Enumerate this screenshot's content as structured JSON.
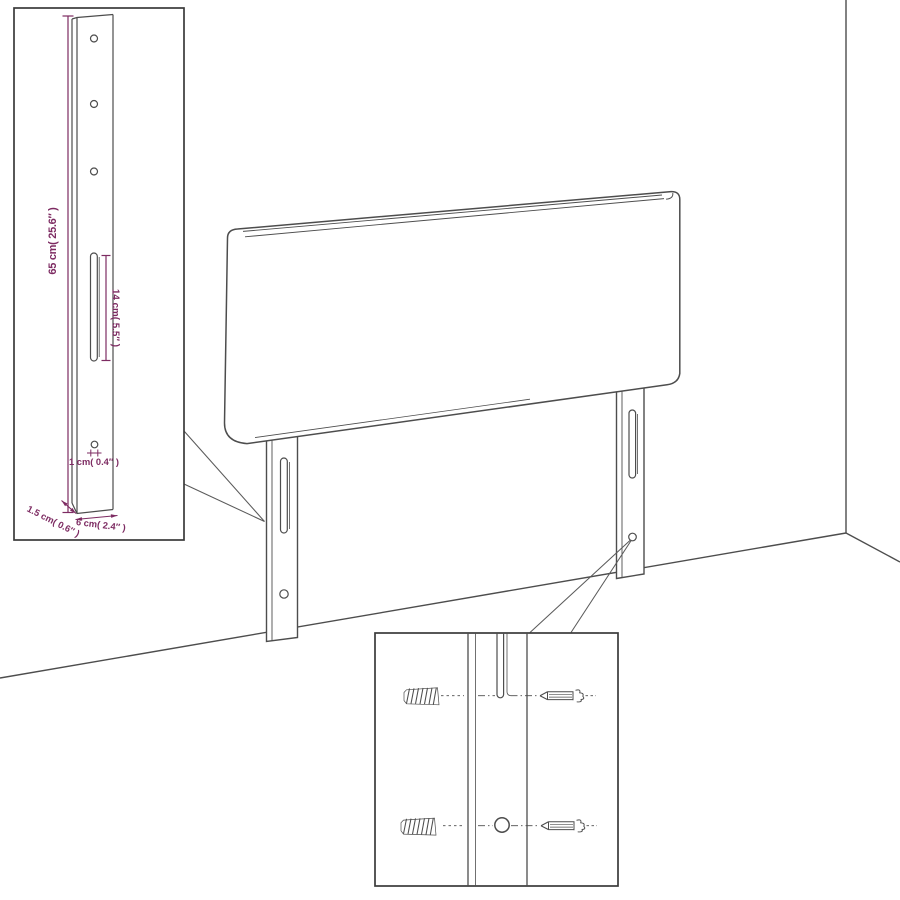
{
  "title": "Headboard wall-mounting dimensions diagram",
  "colors": {
    "background": "#ffffff",
    "line": "#4d4d4d",
    "box_border": "#3a3a3a",
    "dimension": "#7d2b62"
  },
  "labels": {
    "post_height": "65 cm( 25.6″ )",
    "slot_length": "14 cm( 5.5″ )",
    "hole_diameter": "1 cm( 0.4″ )",
    "post_depth": "1.5 cm( 0.6″ )",
    "post_width": "6 cm( 2.4″ )"
  },
  "parts": {
    "main_object": "headboard-with-mounting-legs",
    "inset_top_left": "leg-dimension-detail",
    "inset_bottom": "fastener-detail",
    "fasteners": [
      "wall-plug",
      "screw"
    ]
  }
}
